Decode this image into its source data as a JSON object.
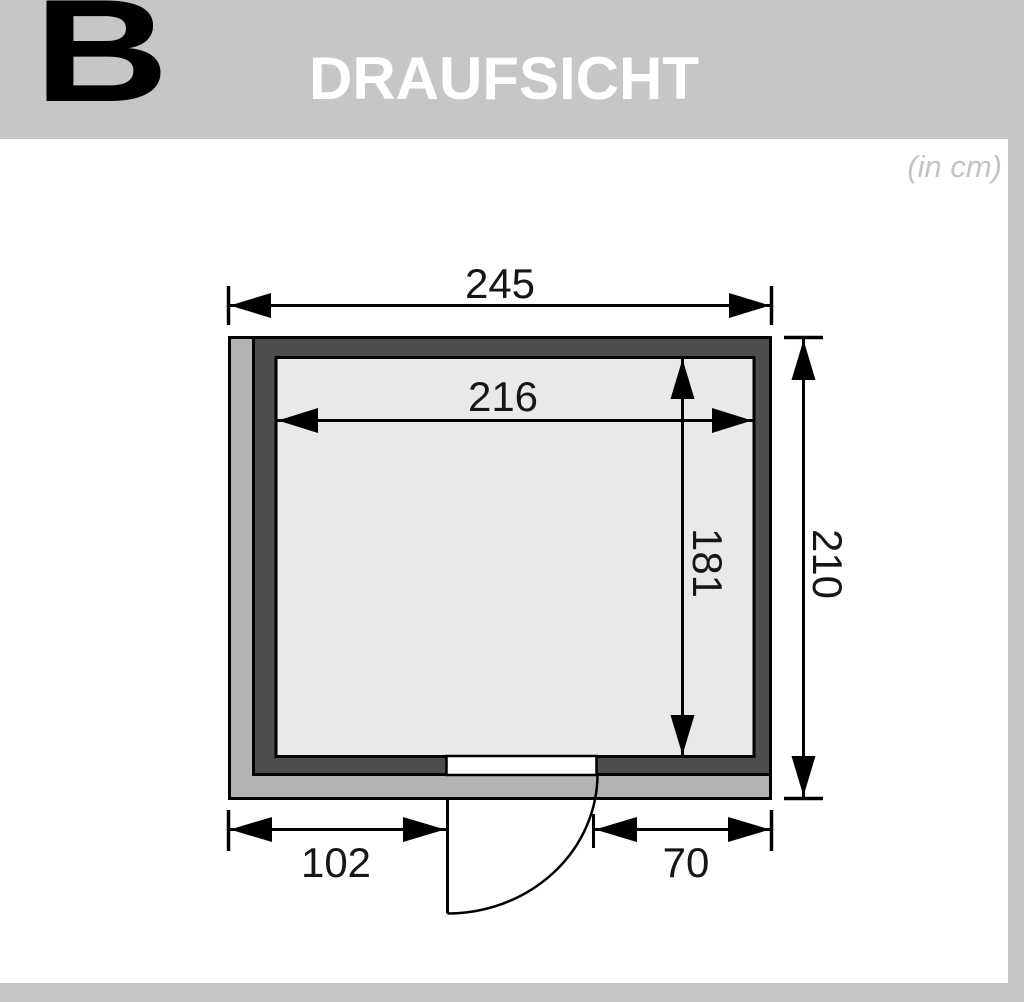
{
  "header": {
    "section_letter": "B",
    "title": "DRAUFSICHT"
  },
  "unit_note": "(in cm)",
  "plan": {
    "type": "floor-plan-top-view",
    "dimensions_cm": {
      "outer_width": "245",
      "inner_width": "216",
      "inner_depth": "181",
      "outer_depth": "210",
      "left_of_door": "102",
      "right_of_door": "70"
    },
    "colors": {
      "header_bar": "#c6c6c6",
      "title_text": "#ffffff",
      "wall_dark": "#4d4d4d",
      "wall_light": "#b3b3b3",
      "floor": "#e9e9e9",
      "line": "#000000",
      "unit_note_text": "#c3c3c3"
    }
  }
}
